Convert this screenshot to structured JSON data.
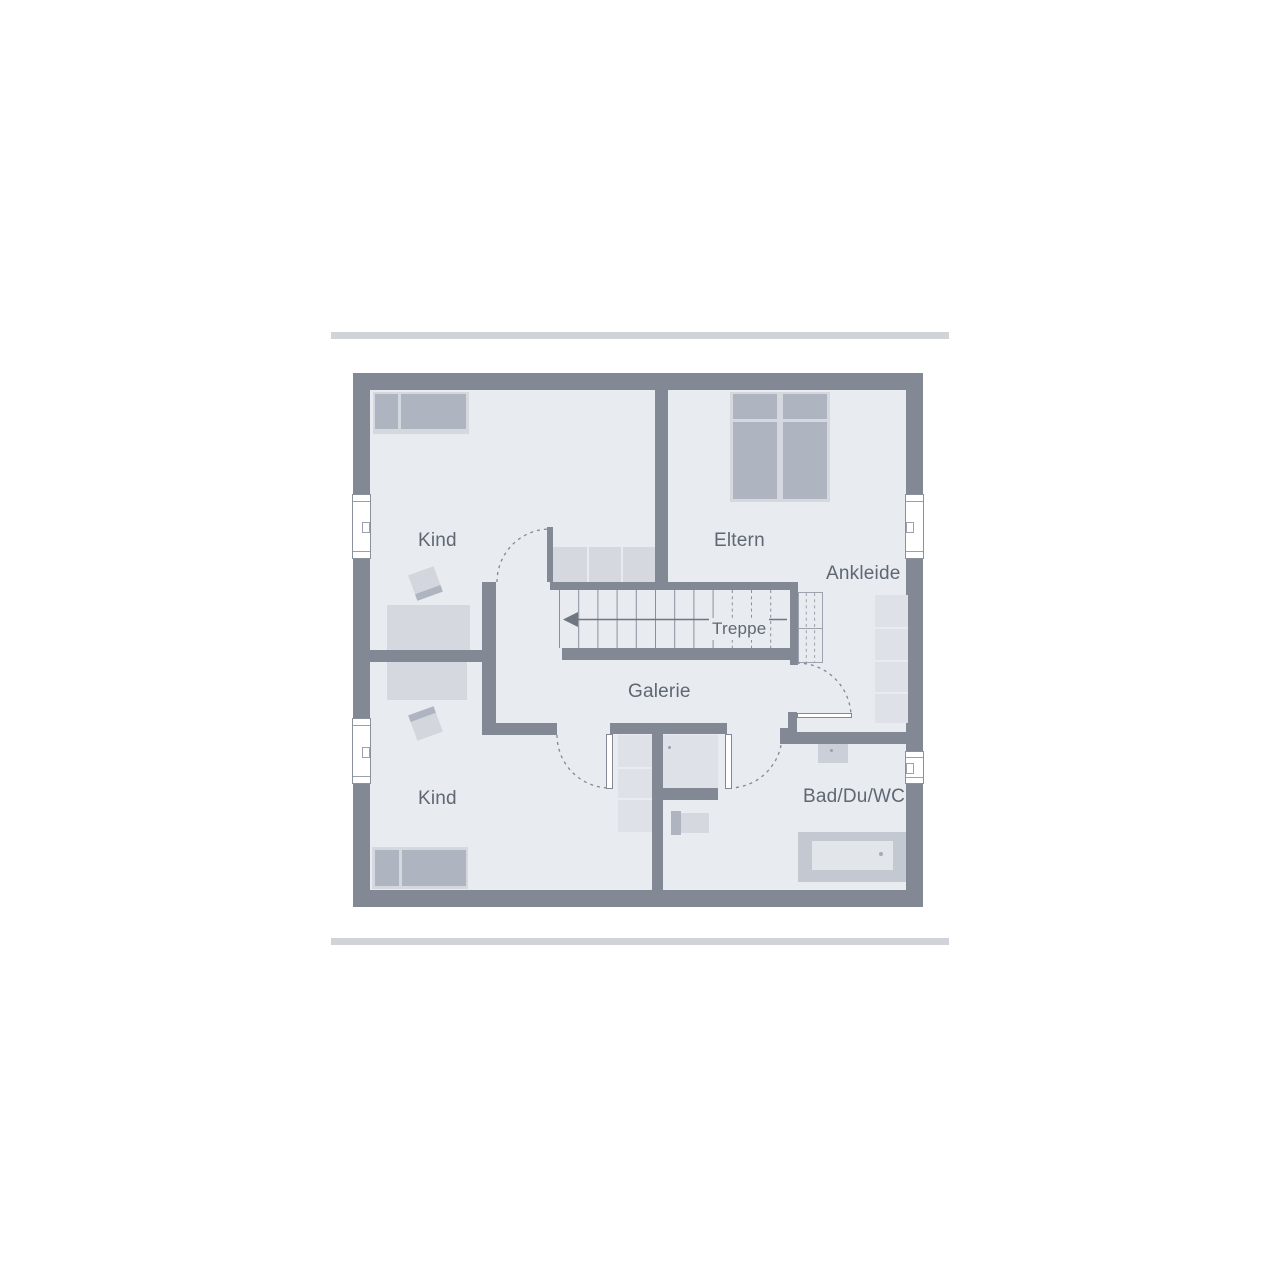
{
  "floorplan": {
    "title": "Obergeschoss Grundriss",
    "rooms": [
      {
        "id": "kind-top",
        "label": "Kind"
      },
      {
        "id": "eltern",
        "label": "Eltern"
      },
      {
        "id": "ankleide",
        "label": "Ankleide"
      },
      {
        "id": "galerie",
        "label": "Galerie"
      },
      {
        "id": "kind-bottom",
        "label": "Kind"
      },
      {
        "id": "bad-du-wc",
        "label": "Bad/Du/WC"
      }
    ],
    "stair": {
      "label": "Treppe",
      "direction_icon": "left-arrow"
    },
    "colors": {
      "wall": "#828994",
      "floor": "#E8EBF0",
      "divider_bar": "#D0D3D7",
      "furniture_light": "#D5D8DF",
      "furniture_medium": "#AFB5C0",
      "label_text": "#5E6772"
    }
  }
}
